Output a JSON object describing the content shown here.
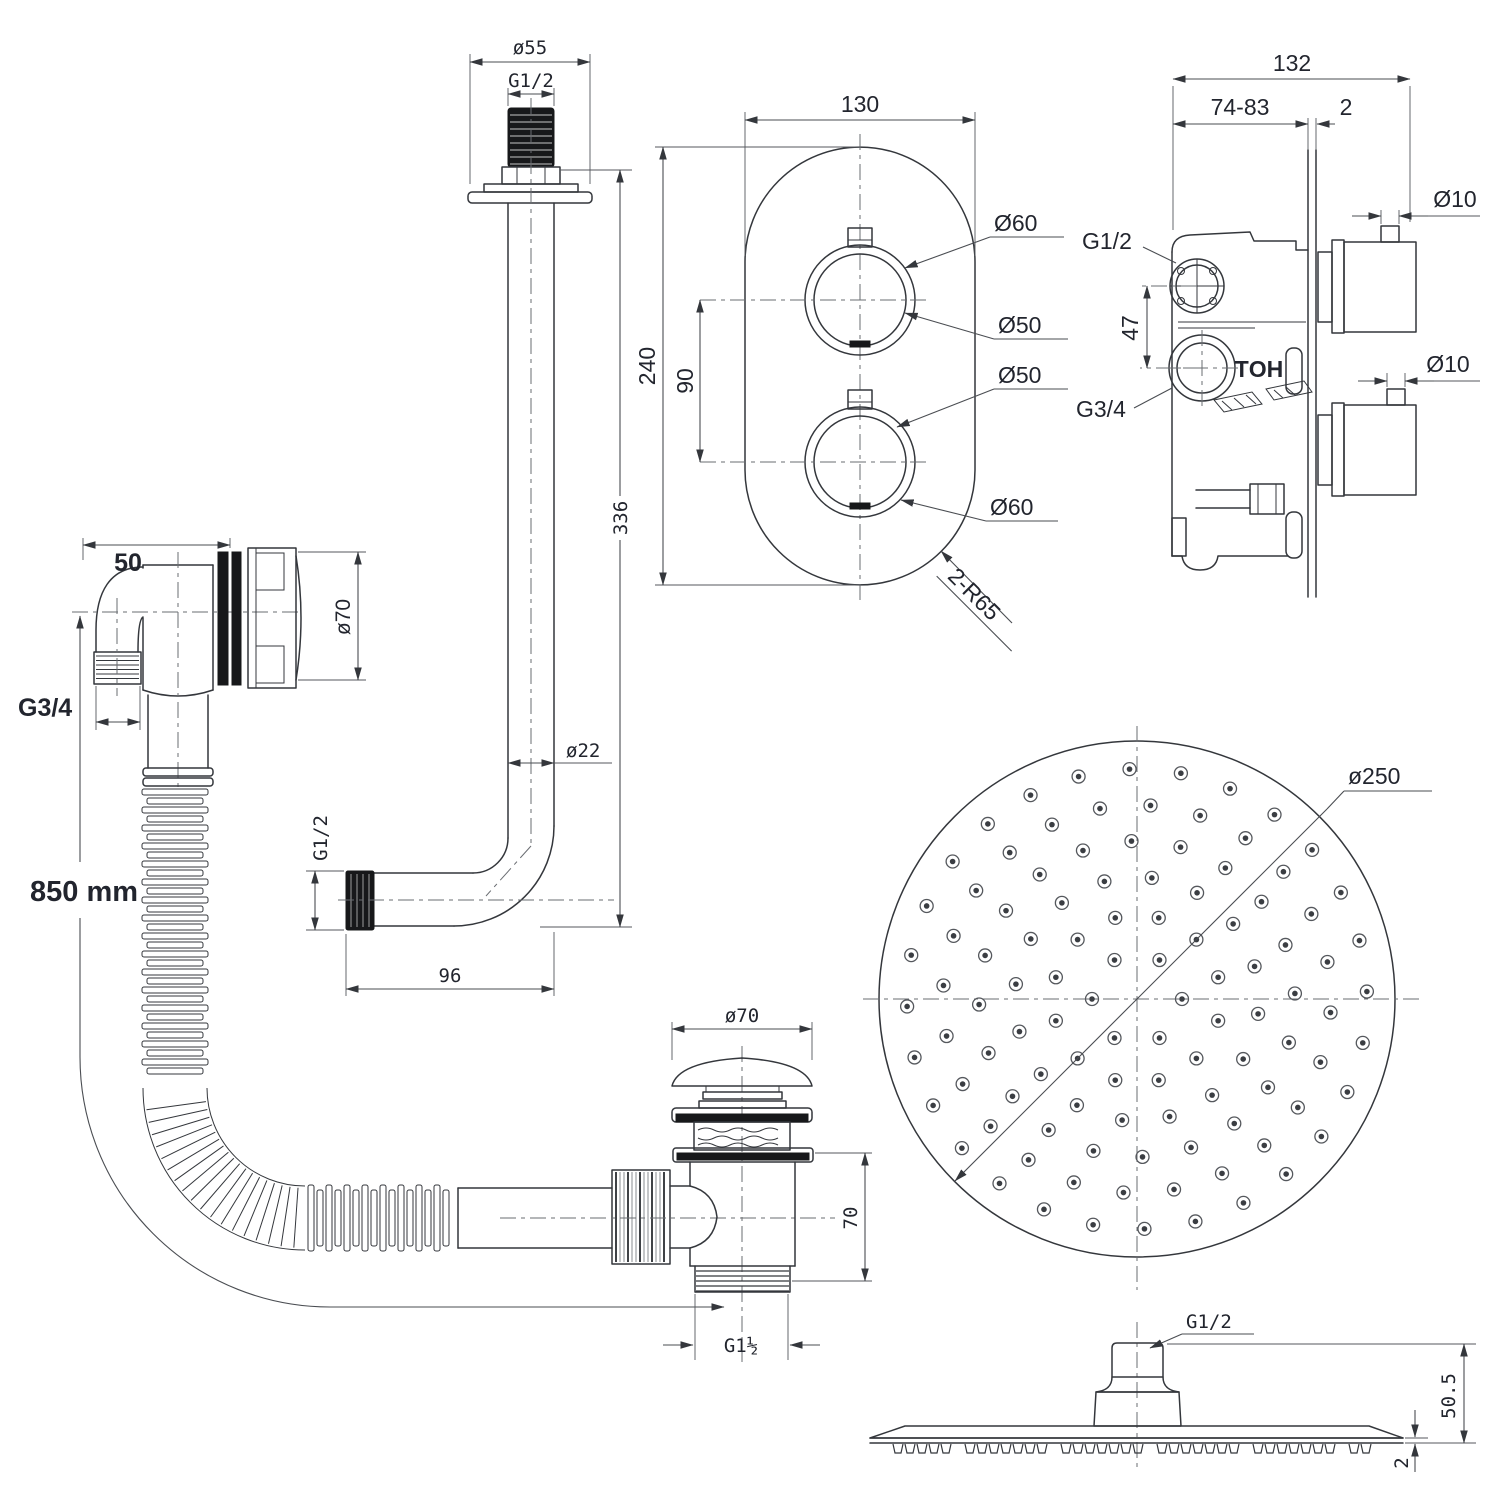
{
  "drawing_title": "Concealed thermostatic shower system installation drawing",
  "colors": {
    "ink": "#34373c",
    "text": "#22252e",
    "background": "#ffffff"
  },
  "views": {
    "arm": {
      "dims": {
        "flange_dia": "ø55",
        "thread": "G1/2",
        "length": "336",
        "pipe_dia": "ø22",
        "horizontal": "96",
        "end_thread": "G1/2"
      }
    },
    "plate": {
      "dims": {
        "width": "130",
        "height": "240",
        "knob_spacing": "90",
        "top_outer": "Ø60",
        "top_inner": "Ø50",
        "bottom_inner": "Ø50",
        "bottom_outer": "Ø60",
        "corner_radius": "2-R65"
      }
    },
    "valve": {
      "dims": {
        "width": "132",
        "recess_depth": "74-83",
        "plate_thickness": "2",
        "inlet_top": "G1/2",
        "port_spacing": "47",
        "inlet_bottom": "G3/4",
        "hot_marking": "HOT",
        "spindle_top": "Ø10",
        "spindle_bottom": "Ø10"
      }
    },
    "overflow": {
      "dims": {
        "body_depth": "50",
        "face_dia": "ø70",
        "thread": "G3/4",
        "hose_length": "850 mm"
      }
    },
    "waste": {
      "dims": {
        "cap_dia": "ø70",
        "body_height": "70",
        "outlet_thread": "G1½"
      }
    },
    "head": {
      "dims": {
        "dia": "ø250"
      }
    },
    "head_side": {
      "dims": {
        "thread": "G1/2",
        "total_height": "50.5",
        "edge_thickness": "2"
      }
    }
  }
}
